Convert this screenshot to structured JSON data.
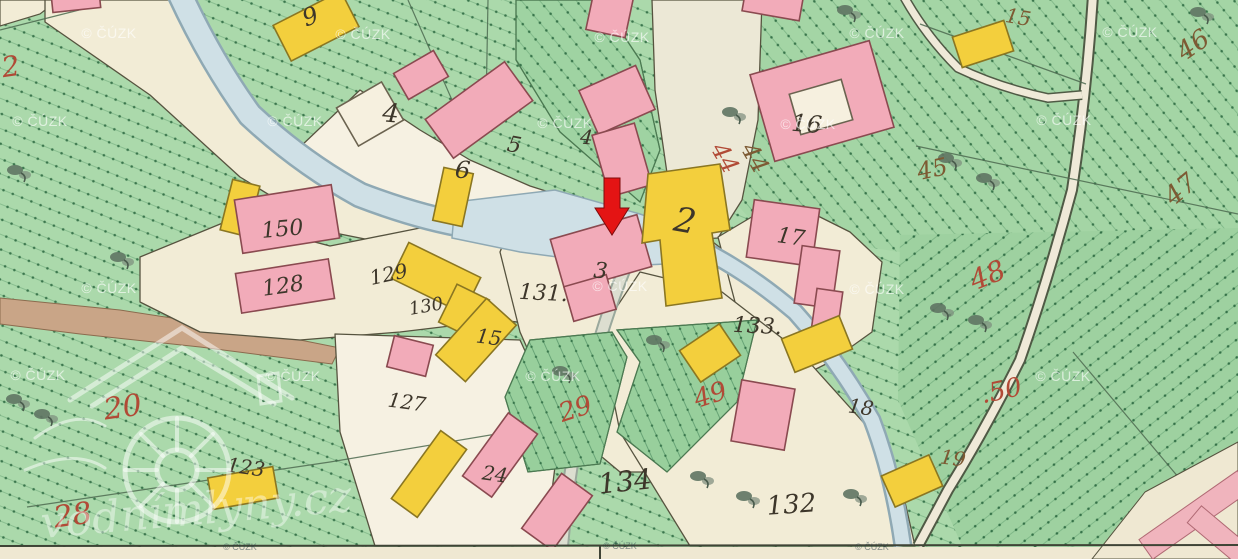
{
  "map": {
    "description": "Historical cadastral map sheet detail with village centre, stream, roads and numbered parcels",
    "attribution_watermark": "© ČÚZK",
    "logo_watermark_text": "vodnímlyny.cz",
    "marker": {
      "type": "red-arrow-down",
      "points_at_building": "3",
      "x": 612,
      "y": 205
    },
    "colors": {
      "meadow_green": "#abd9ab",
      "meadow_green_right": "#a4d5a5",
      "meadow_green_bottom_right": "#9ed1a0",
      "garden_green": "#98cf9c",
      "road_cream": "#f2ecd6",
      "yard_white": "#f6f1e2",
      "stream_blue": "#cfe0e6",
      "masonry_pink": "#f2abb9",
      "wood_yellow": "#f3cf3d",
      "field_tan": "#c9a587",
      "arrow_red": "#e41414",
      "label_red": "#b14a36",
      "label_brown": "#7d5a33",
      "label_dark": "#3d362a"
    },
    "labels_dark": [
      {
        "t": "9",
        "x": 313,
        "y": 24,
        "s": 24,
        "r": -20
      },
      {
        "t": "4",
        "x": 390,
        "y": 122,
        "s": 26,
        "r": 5
      },
      {
        "t": "5",
        "x": 513,
        "y": 152,
        "s": 22,
        "r": 10
      },
      {
        "t": "6",
        "x": 462,
        "y": 178,
        "s": 24,
        "r": 5
      },
      {
        "t": "4",
        "x": 586,
        "y": 144,
        "s": 20,
        "r": 5
      },
      {
        "t": "2",
        "x": 683,
        "y": 232,
        "s": 34,
        "r": 10
      },
      {
        "t": "3",
        "x": 600,
        "y": 278,
        "s": 22,
        "r": 5
      },
      {
        "t": "16",
        "x": 806,
        "y": 132,
        "s": 24,
        "r": 5
      },
      {
        "t": "17",
        "x": 790,
        "y": 244,
        "s": 22,
        "r": 8
      },
      {
        "t": "18",
        "x": 860,
        "y": 414,
        "s": 20,
        "r": 8
      },
      {
        "t": "150",
        "x": 283,
        "y": 236,
        "s": 22,
        "r": -5
      },
      {
        "t": "128",
        "x": 284,
        "y": 293,
        "s": 22,
        "r": -8
      },
      {
        "t": "129",
        "x": 390,
        "y": 281,
        "s": 20,
        "r": -12
      },
      {
        "t": "130",
        "x": 427,
        "y": 312,
        "s": 18,
        "r": -10
      },
      {
        "t": "131.",
        "x": 543,
        "y": 300,
        "s": 22,
        "r": 3
      },
      {
        "t": "127",
        "x": 406,
        "y": 409,
        "s": 20,
        "r": 8
      },
      {
        "t": "133.",
        "x": 757,
        "y": 333,
        "s": 22,
        "r": 3
      },
      {
        "t": "134",
        "x": 626,
        "y": 491,
        "s": 28,
        "r": -6
      },
      {
        "t": "132",
        "x": 792,
        "y": 513,
        "s": 26,
        "r": -4
      },
      {
        "t": "24",
        "x": 494,
        "y": 481,
        "s": 20,
        "r": 8
      },
      {
        "t": "15",
        "x": 488,
        "y": 344,
        "s": 20,
        "r": 8
      },
      {
        "t": "123",
        "x": 245,
        "y": 474,
        "s": 20,
        "r": 8
      }
    ],
    "labels_brown": [
      {
        "t": "15",
        "x": 1017,
        "y": 24,
        "s": 20,
        "r": 10
      },
      {
        "t": "44",
        "x": 748,
        "y": 162,
        "s": 24,
        "r": 60
      },
      {
        "t": "45",
        "x": 934,
        "y": 177,
        "s": 24,
        "r": -12
      },
      {
        "t": "46",
        "x": 1198,
        "y": 52,
        "s": 26,
        "r": -35
      },
      {
        "t": "47",
        "x": 1186,
        "y": 196,
        "s": 26,
        "r": -40
      },
      {
        "t": "19",
        "x": 952,
        "y": 465,
        "s": 20,
        "r": 8
      }
    ],
    "labels_red": [
      {
        "t": "2",
        "x": 12,
        "y": 76,
        "s": 28,
        "r": -8
      },
      {
        "t": "44",
        "x": 718,
        "y": 162,
        "s": 24,
        "r": 60
      },
      {
        "t": "20",
        "x": 124,
        "y": 417,
        "s": 30,
        "r": -8
      },
      {
        "t": "28",
        "x": 74,
        "y": 525,
        "s": 30,
        "r": -8
      },
      {
        "t": "29",
        "x": 578,
        "y": 417,
        "s": 26,
        "r": -18
      },
      {
        "t": "49",
        "x": 713,
        "y": 403,
        "s": 26,
        "r": -18
      },
      {
        "t": "48",
        "x": 991,
        "y": 284,
        "s": 28,
        "r": -22
      },
      {
        "t": ".50",
        "x": 1003,
        "y": 399,
        "s": 26,
        "r": -12
      }
    ],
    "cuzk_watermarks": [
      {
        "x": 109,
        "y": 38
      },
      {
        "x": 363,
        "y": 39
      },
      {
        "x": 622,
        "y": 42
      },
      {
        "x": 877,
        "y": 38
      },
      {
        "x": 1130,
        "y": 37
      },
      {
        "x": 40,
        "y": 126
      },
      {
        "x": 295,
        "y": 126
      },
      {
        "x": 565,
        "y": 128
      },
      {
        "x": 808,
        "y": 129
      },
      {
        "x": 1064,
        "y": 125
      },
      {
        "x": 109,
        "y": 293
      },
      {
        "x": 620,
        "y": 291
      },
      {
        "x": 877,
        "y": 294
      },
      {
        "x": 38,
        "y": 380
      },
      {
        "x": 293,
        "y": 381
      },
      {
        "x": 553,
        "y": 381
      },
      {
        "x": 1063,
        "y": 381
      }
    ],
    "cuzk_edge_watermarks": [
      {
        "x": 240,
        "y": 550
      },
      {
        "x": 620,
        "y": 549
      },
      {
        "x": 872,
        "y": 550
      }
    ],
    "buildings": [
      {
        "c": "Y",
        "x": 278,
        "y": 6,
        "w": 76,
        "h": 40,
        "r": -27
      },
      {
        "c": "P",
        "x": 52,
        "y": -6,
        "w": 48,
        "h": 16,
        "r": -6
      },
      {
        "c": "P",
        "x": 590,
        "y": -10,
        "w": 40,
        "h": 44,
        "r": 12
      },
      {
        "c": "P",
        "x": 744,
        "y": -12,
        "w": 58,
        "h": 28,
        "r": 10
      },
      {
        "c": "P",
        "x": 398,
        "y": 60,
        "w": 46,
        "h": 30,
        "r": -30
      },
      {
        "c": "W",
        "x": 344,
        "y": 92,
        "w": 52,
        "h": 44,
        "r": -30
      },
      {
        "c": "P",
        "x": 430,
        "y": 86,
        "w": 98,
        "h": 48,
        "r": -36
      },
      {
        "c": "P",
        "x": 586,
        "y": 76,
        "w": 62,
        "h": 48,
        "r": -24
      },
      {
        "c": "P",
        "x": 600,
        "y": 128,
        "w": 44,
        "h": 64,
        "r": -16
      },
      {
        "c": "P",
        "x": 760,
        "y": 56,
        "w": 124,
        "h": 90,
        "r": -16
      },
      {
        "c": "W",
        "x": 794,
        "y": 86,
        "w": 54,
        "h": 42,
        "r": -16
      },
      {
        "c": "Y",
        "x": 956,
        "y": 28,
        "w": 54,
        "h": 32,
        "r": -18
      },
      {
        "c": "Y",
        "x": 226,
        "y": 182,
        "w": 28,
        "h": 52,
        "r": 14
      },
      {
        "c": "P",
        "x": 238,
        "y": 192,
        "w": 98,
        "h": 54,
        "r": -9
      },
      {
        "c": "P",
        "x": 238,
        "y": 266,
        "w": 94,
        "h": 40,
        "r": -9
      },
      {
        "c": "Y",
        "x": 438,
        "y": 170,
        "w": 30,
        "h": 54,
        "r": 12
      },
      {
        "c": "Y",
        "x": 396,
        "y": 258,
        "w": 80,
        "h": 40,
        "r": 26
      },
      {
        "c": "Y",
        "x": 446,
        "y": 290,
        "w": 36,
        "h": 42,
        "r": 26
      },
      {
        "c": "P",
        "x": 556,
        "y": 226,
        "w": 90,
        "h": 54,
        "r": -16
      },
      {
        "c": "P",
        "x": 568,
        "y": 280,
        "w": 44,
        "h": 36,
        "r": -16
      },
      {
        "c": "Y",
        "pts": [
          [
            648,
            174
          ],
          [
            720,
            164
          ],
          [
            730,
            230
          ],
          [
            712,
            233
          ],
          [
            722,
            298
          ],
          [
            666,
            306
          ],
          [
            660,
            240
          ],
          [
            642,
            243
          ]
        ]
      },
      {
        "c": "P",
        "x": 750,
        "y": 204,
        "w": 66,
        "h": 58,
        "r": 8
      },
      {
        "c": "P",
        "x": 798,
        "y": 248,
        "w": 38,
        "h": 58,
        "r": 8
      },
      {
        "c": "P",
        "x": 814,
        "y": 290,
        "w": 26,
        "h": 42,
        "r": 8
      },
      {
        "c": "Y",
        "x": 786,
        "y": 326,
        "w": 62,
        "h": 36,
        "r": -22
      },
      {
        "c": "Y",
        "x": 686,
        "y": 334,
        "w": 48,
        "h": 38,
        "r": -34
      },
      {
        "c": "P",
        "x": 736,
        "y": 384,
        "w": 54,
        "h": 62,
        "r": 10
      },
      {
        "c": "Y",
        "x": 886,
        "y": 464,
        "w": 52,
        "h": 34,
        "r": -24
      },
      {
        "c": "P",
        "x": 390,
        "y": 340,
        "w": 40,
        "h": 32,
        "r": 14
      },
      {
        "c": "Y",
        "x": 456,
        "y": 302,
        "w": 40,
        "h": 76,
        "r": 42
      },
      {
        "c": "Y",
        "x": 413,
        "y": 432,
        "w": 32,
        "h": 84,
        "r": 36
      },
      {
        "c": "P",
        "x": 482,
        "y": 416,
        "w": 36,
        "h": 78,
        "r": 36
      },
      {
        "c": "P",
        "x": 538,
        "y": 478,
        "w": 38,
        "h": 68,
        "r": 36
      },
      {
        "c": "Y",
        "x": 210,
        "y": 472,
        "w": 66,
        "h": 32,
        "r": -10
      }
    ],
    "trees": [
      {
        "x": 845,
        "y": 10
      },
      {
        "x": 730,
        "y": 112
      },
      {
        "x": 946,
        "y": 158
      },
      {
        "x": 984,
        "y": 178
      },
      {
        "x": 938,
        "y": 308
      },
      {
        "x": 976,
        "y": 320
      },
      {
        "x": 1198,
        "y": 12
      },
      {
        "x": 654,
        "y": 340
      },
      {
        "x": 560,
        "y": 371
      },
      {
        "x": 698,
        "y": 476
      },
      {
        "x": 744,
        "y": 496
      },
      {
        "x": 851,
        "y": 494
      },
      {
        "x": 14,
        "y": 399
      },
      {
        "x": 42,
        "y": 414
      },
      {
        "x": 118,
        "y": 257
      },
      {
        "x": 15,
        "y": 170
      }
    ]
  }
}
